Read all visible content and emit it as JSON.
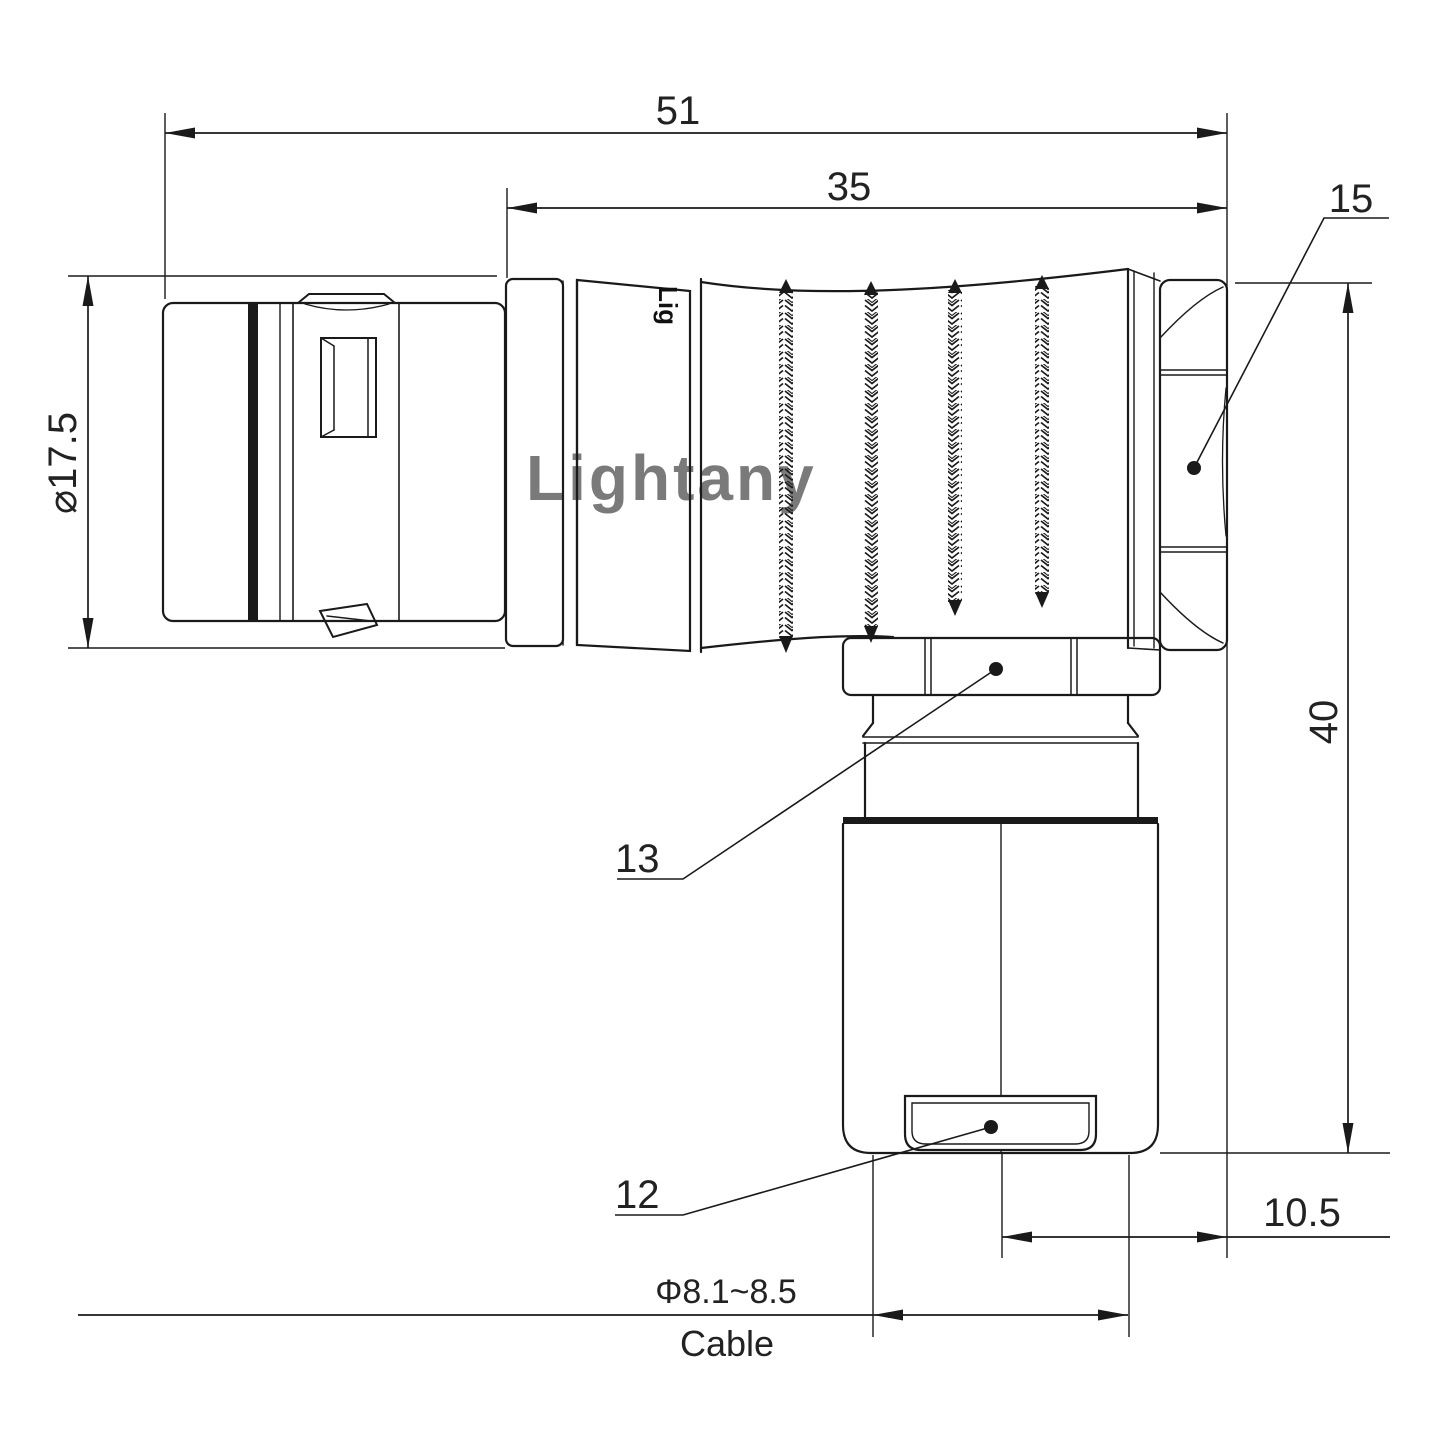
{
  "drawing": {
    "watermark": "Lightany",
    "body_marking": "Lig",
    "dimensions": {
      "overall_length": "51",
      "body_length": "35",
      "nut_size": "15",
      "height": "40",
      "plug_diameter": "⌀17.5",
      "part_coupling_nut": "13",
      "part_cable_bushing": "12",
      "offset": "10.5",
      "cable_diameter": "Φ8.1~8.5",
      "cable_word": "Cable"
    },
    "colors": {
      "line": "#1a1a1a",
      "text": "#222222",
      "watermark": "#f3c6c6",
      "background": "#ffffff"
    }
  }
}
